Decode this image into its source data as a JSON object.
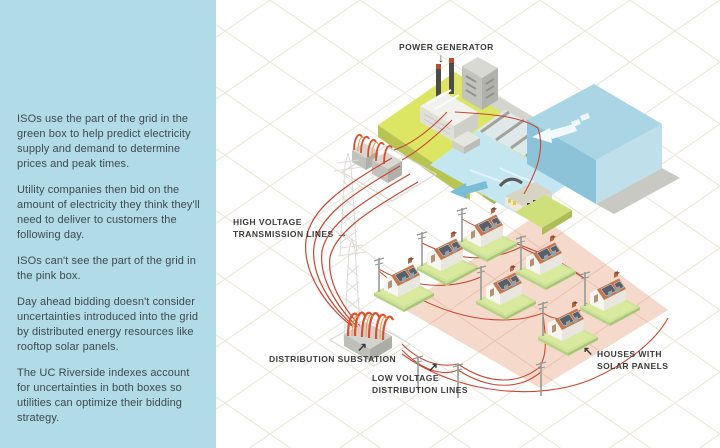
{
  "sidebar": {
    "paragraphs": [
      "ISOs use the part of the grid in the green box to help predict electricity supply and demand to determine prices and peak times.",
      "Utility companies then bid on the amount of electricity they think they'll need to deliver to customers the following day.",
      "ISOs can't see the part of the grid in the pink box.",
      "Day ahead bidding doesn't consider uncertainties introduced into the grid by distributed energy resources like rooftop solar panels.",
      "The UC Riverside indexes account for uncertainties in both boxes so utilities can optimize their bidding strategy."
    ]
  },
  "labels": {
    "power_generator": {
      "text": "POWER GENERATOR",
      "arrow": "↓"
    },
    "high_voltage": {
      "line1": "HIGH VOLTAGE",
      "line2": "TRANSMISSION LINES",
      "arrow": "→"
    },
    "distribution_substation": {
      "text": "DISTRIBUTION SUBSTATION",
      "arrow": "↗"
    },
    "low_voltage": {
      "line1": "LOW VOLTAGE",
      "line2": "DISTRIBUTION LINES",
      "arrow": "↗"
    },
    "houses": {
      "line1": "HOUSES WITH",
      "line2": "SOLAR PANELS",
      "arrow": "↖"
    }
  },
  "colors": {
    "sidebar_bg": "#b1dbe7",
    "sidebar_text": "#3e4950",
    "label_text": "#3b3b3b",
    "wire_red": "#c94731",
    "green_box": "#dde663",
    "pink_box": "#f5d9cb",
    "water": "#a9d5e5",
    "grid_line": "#eae5d6"
  }
}
